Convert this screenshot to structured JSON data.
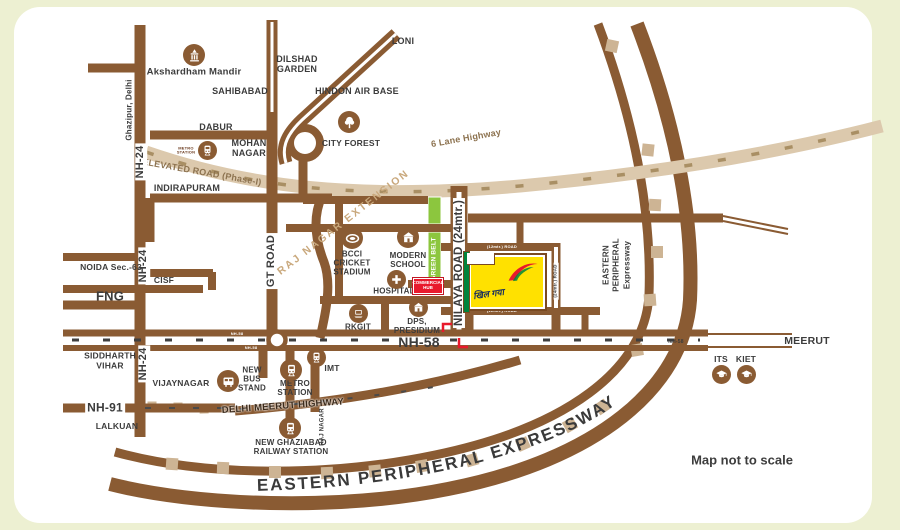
{
  "colors": {
    "road": "#8a5b33",
    "band": "#dcc9ad",
    "band_dash": "#a98f64",
    "green_belt": "#8cc63e",
    "site_yellow": "#ffe100",
    "accent_red": "#ed1c24",
    "tan_square": "#cdb494",
    "text": "#3c3c3c"
  },
  "map": {
    "note": "Map not to scale",
    "site": {
      "logo_text": "खिल गया"
    },
    "labels": {
      "loni": "LONI",
      "dilshad_garden": "DILSHAD\nGARDEN",
      "sahibabad": "SAHIBABAD",
      "hindon_air_base": "HINDON AIR BASE",
      "akshardham": "Akshardham Mandir",
      "ghazipur_delhi": "Ghazipur, Delhi",
      "dabur": "DABUR",
      "mohan_nagar": "MOHAN\nNAGAR",
      "metro_station_small": "METRO\nSTATION",
      "city_forest": "CITY FOREST",
      "elevated_road": "ELEVATED ROAD (Phase-I)",
      "six_lane_highway": "6 Lane Highway",
      "indirapuram": "INDIRAPURAM",
      "nh24": "NH-24",
      "gt_road": "GT ROAD",
      "raj_nagar_extension": "RAJ NAGAR EXTENSION",
      "noida_sec63": "NOIDA Sec.-63",
      "cisf": "CISF",
      "fng": "FNG",
      "bcci": "BCCI\nCRICKET\nSTADIUM",
      "modern_school": "MODERN\nSCHOOL",
      "green_belt": "GREEN BELT",
      "hospital": "HOSPITAL",
      "commercial_hub": "COMMERCIAL\nHUB",
      "rkgit": "RKGIT",
      "dps_presidium": "DPS,\nPRESIDIUM",
      "nilaya_road": "NILAYA ROAD (24mtr.)",
      "road_24mtr": "(24mtr.) ROAD",
      "road_12mtr": "(12mtr.) ROAD",
      "nh58": "NH-58",
      "meerut": "MEERUT",
      "its": "ITS",
      "kiet": "KIET",
      "epe_vertical": "EASTERN\nPERIPHERAL\nExpressway",
      "siddharth_vihar": "SIDDHARTH\nVIHAR",
      "vijaynagar": "VIJAYNAGAR",
      "nh91": "NH-91",
      "lalkuan": "LALKUAN",
      "new_bus_stand": "NEW\nBUS\nSTAND",
      "metro_station": "METRO\nSTATION",
      "imt": "IMT",
      "delhi_meerut_highway": "DELHI MEERUT HIGHWAY",
      "raj_nagar": "RAJ NAGAR",
      "new_ghaziabad_rs": "NEW GHAZIABAD\nRAILWAY STATION",
      "epe_bottom": "EASTERN PERIPHERAL EXPRESSWAY"
    }
  }
}
